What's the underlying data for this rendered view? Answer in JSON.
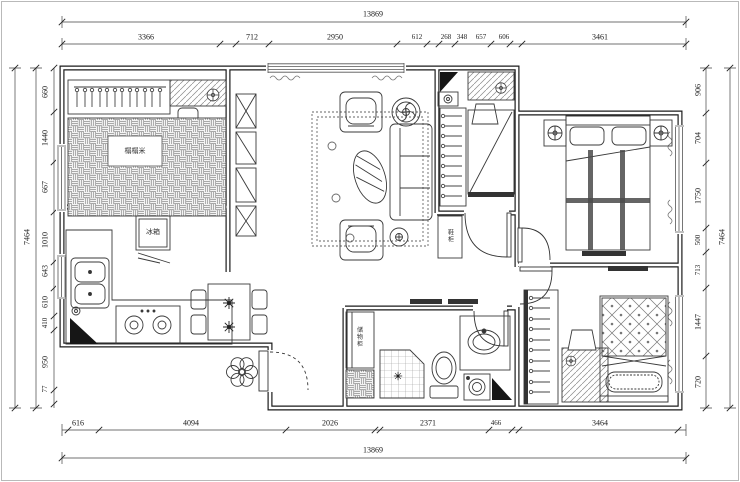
{
  "dims": {
    "top_total": "13869",
    "top": [
      "3366",
      "712",
      "2950",
      "612",
      "268",
      "348",
      "657",
      "606",
      "3461"
    ],
    "bottom": [
      "616",
      "4094",
      "2026",
      "2371",
      "466",
      "3464"
    ],
    "bottom_total": "13869",
    "left": [
      "660",
      "1440",
      "667",
      "1010",
      "643",
      "610",
      "410",
      "950",
      "77"
    ],
    "left_total": "7464",
    "right": [
      "906",
      "704",
      "1750",
      "500",
      "713",
      "1447",
      "720"
    ],
    "right_total": "7464"
  },
  "labels": {
    "fridge": "冰箱",
    "tatami_bed": "榻榻米",
    "hall_cabinet": "鞋柜",
    "bath_cabinet": "储物柜"
  }
}
